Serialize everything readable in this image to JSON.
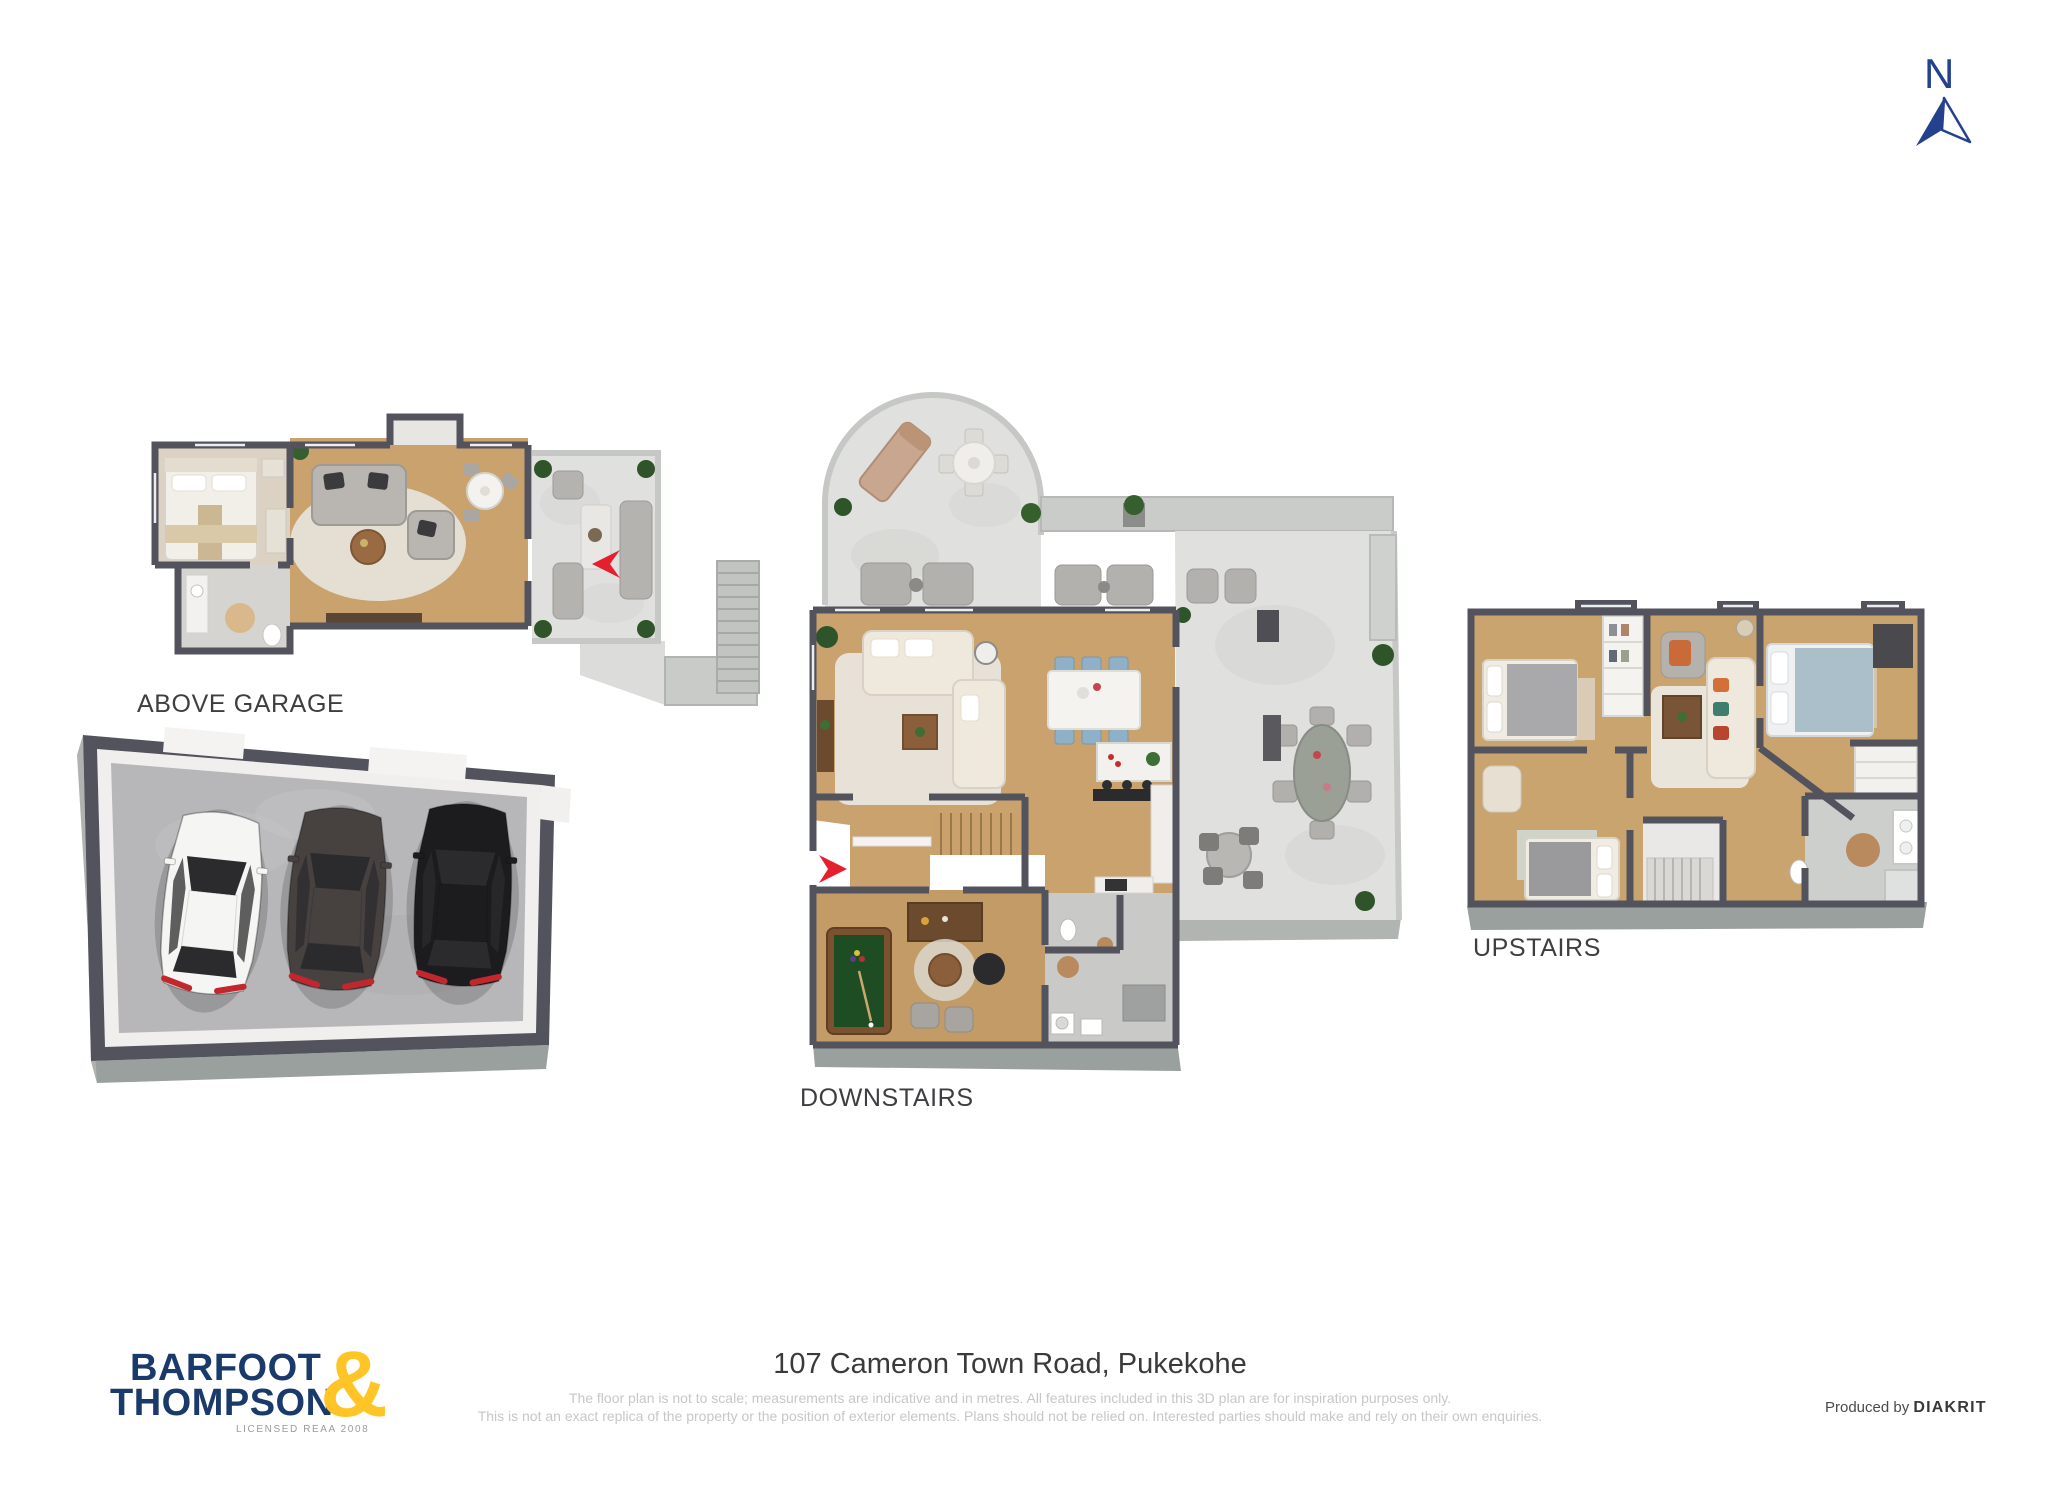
{
  "compass": {
    "label": "N"
  },
  "plans": {
    "above_garage": {
      "label": "ABOVE GARAGE"
    },
    "downstairs": {
      "label": "DOWNSTAIRS"
    },
    "upstairs": {
      "label": "UPSTAIRS"
    }
  },
  "footer": {
    "logo": {
      "line1": "BARFOOT",
      "line2": "THOMPSON",
      "ampersand": "&",
      "tagline": "LICENSED REAA 2008"
    },
    "address": "107 Cameron Town Road, Pukekohe",
    "disclaimer_line1": "The floor plan is not to scale; measurements are indicative and in metres. All features included in this 3D plan are for inspiration purposes only.",
    "disclaimer_line2": "This is not an exact replica of the property or the position of exterior elements. Plans should not be relied on. Interested parties should make and rely on their own enquiries.",
    "produced_by_prefix": "Produced by",
    "producer": "DIAKRIT"
  },
  "colors": {
    "logo_navy": "#1a3a6b",
    "logo_yellow": "#ffc425",
    "compass_blue": "#24418e",
    "entry_arrow_red": "#e5202e",
    "wall_dark": "#53535d",
    "wood_floor": "#c9a26e",
    "marble_patio": "#e0e0de",
    "concrete_floor": "#b7b7b9"
  }
}
